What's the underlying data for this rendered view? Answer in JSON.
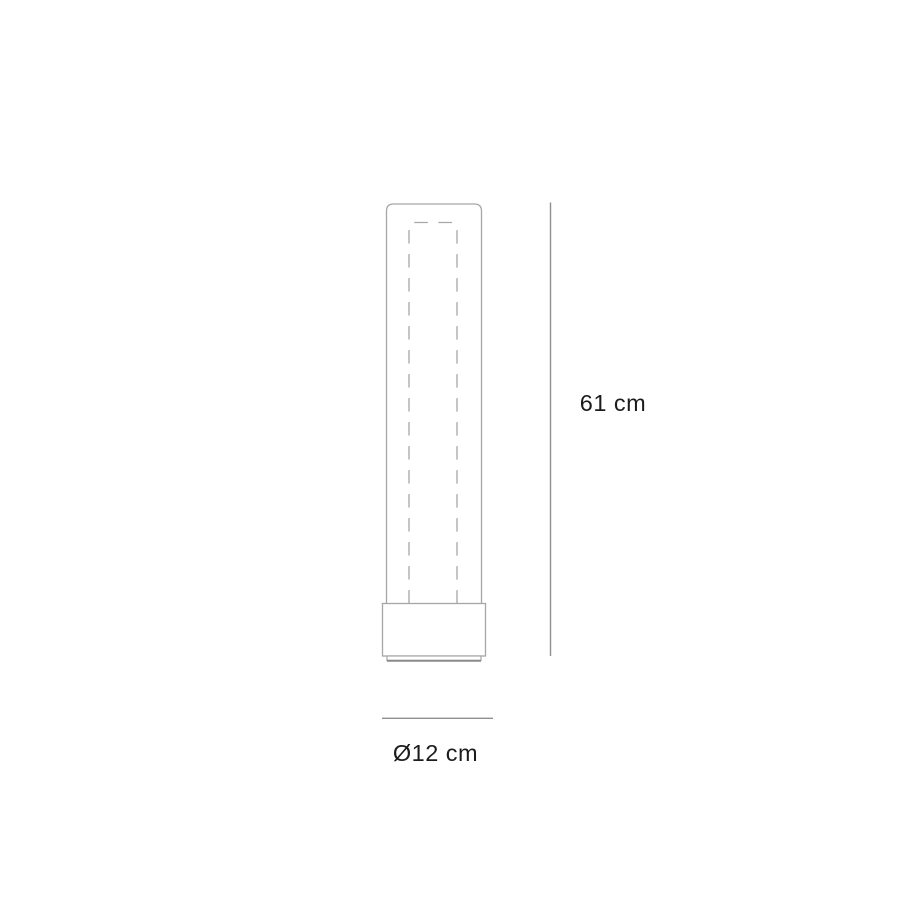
{
  "diagram": {
    "labels": {
      "height": "61 cm",
      "diameter": "Ø12 cm"
    },
    "colors": {
      "outline": "#a6a6a6",
      "dimension_line": "#8f8f8f",
      "rim_shadow": "#8a8a8a",
      "text": "#1c1c1c",
      "background": "#ffffff"
    }
  }
}
